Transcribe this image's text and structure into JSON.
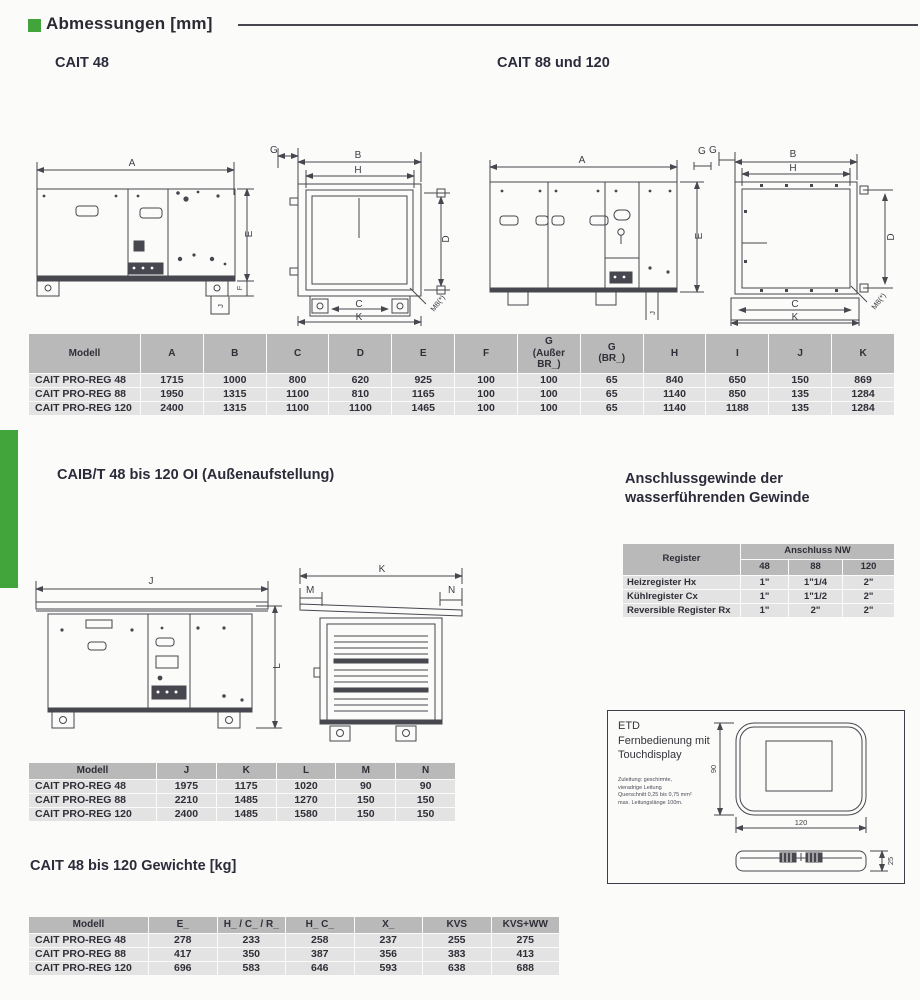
{
  "accent": {
    "green": "#41a53c"
  },
  "header": {
    "title": "Abmessungen [mm]"
  },
  "sections": {
    "cait48_title": "CAIT 48",
    "cait88_title": "CAIT 88 und 120",
    "caibt_title": "CAIB/T 48 bis 120 OI (Außenaufstellung)",
    "gewinde_title_line1": "Anschlussgewinde der",
    "gewinde_title_line2": "wasserführenden Gewinde",
    "gewichte_title": "CAIT 48 bis 120 Gewichte [kg]"
  },
  "dimension_table": {
    "columns": [
      "Modell",
      "A",
      "B",
      "C",
      "D",
      "E",
      "F",
      "G\n(Außer\nBR_)",
      "G\n(BR_)",
      "H",
      "I",
      "J",
      "K"
    ],
    "rows": [
      [
        "CAIT PRO-REG 48",
        "1715",
        "1000",
        "800",
        "620",
        "925",
        "100",
        "100",
        "65",
        "840",
        "650",
        "150",
        "869"
      ],
      [
        "CAIT PRO-REG 88",
        "1950",
        "1315",
        "1100",
        "810",
        "1165",
        "100",
        "100",
        "65",
        "1140",
        "850",
        "135",
        "1284"
      ],
      [
        "CAIT PRO-REG 120",
        "2400",
        "1315",
        "1100",
        "1100",
        "1465",
        "100",
        "100",
        "65",
        "1140",
        "1188",
        "135",
        "1284"
      ]
    ]
  },
  "register_table": {
    "header": {
      "register": "Register",
      "anschluss": "Anschluss NW",
      "sizes": [
        "48",
        "88",
        "120"
      ]
    },
    "rows": [
      {
        "label": "Heizregister Hx",
        "values": [
          "1\"",
          "1\"1/4",
          "2\""
        ]
      },
      {
        "label": "Kühlregister Cx",
        "values": [
          "1\"",
          "1\"1/2",
          "2\""
        ]
      },
      {
        "label": "Reversible Register Rx",
        "values": [
          "1\"",
          "2\"",
          "2\""
        ]
      }
    ]
  },
  "outdoor_table": {
    "columns": [
      "Modell",
      "J",
      "K",
      "L",
      "M",
      "N"
    ],
    "rows": [
      [
        "CAIT PRO-REG 48",
        "1975",
        "1175",
        "1020",
        "90",
        "90"
      ],
      [
        "CAIT PRO-REG 88",
        "2210",
        "1485",
        "1270",
        "150",
        "150"
      ],
      [
        "CAIT PRO-REG 120",
        "2400",
        "1485",
        "1580",
        "150",
        "150"
      ]
    ]
  },
  "weights_table": {
    "columns": [
      "Modell",
      "E_",
      "H_ / C_ / R_",
      "H_ C_",
      "X_",
      "KVS",
      "KVS+WW"
    ],
    "rows": [
      [
        "CAIT PRO-REG 48",
        "278",
        "233",
        "258",
        "237",
        "255",
        "275"
      ],
      [
        "CAIT PRO-REG 88",
        "417",
        "350",
        "387",
        "356",
        "383",
        "413"
      ],
      [
        "CAIT PRO-REG 120",
        "696",
        "583",
        "646",
        "593",
        "638",
        "688"
      ]
    ]
  },
  "drawings": {
    "cait48_side": {
      "A": "A",
      "E": "E",
      "F": "F",
      "J": "J"
    },
    "cait48_front": {
      "G": "G",
      "B": "B",
      "H": "H",
      "D": "D",
      "C": "C",
      "K": "K",
      "M8": "M8(*)"
    },
    "cait88_side": {
      "A": "A",
      "G": "G",
      "E": "E",
      "J": "J"
    },
    "cait88_front": {
      "G": "G",
      "B": "B",
      "H": "H",
      "D": "D",
      "C": "C",
      "K": "K",
      "M8": "M8(*)"
    },
    "caibt_side": {
      "J": "J",
      "L": "L"
    },
    "caibt_end": {
      "K": "K",
      "M": "M",
      "N": "N"
    }
  },
  "etd": {
    "title_lines": [
      "ETD",
      "Fernbedienung mit",
      "Touchdisplay"
    ],
    "note_lines": [
      "Zuleitung: geschirmte,",
      "vieradrige Leitung",
      "Querschnitt 0,25 bis 0,75 mm²",
      "max. Leitungslänge 100m."
    ],
    "dims": {
      "height": "90",
      "width": "120",
      "depth": "25"
    }
  }
}
